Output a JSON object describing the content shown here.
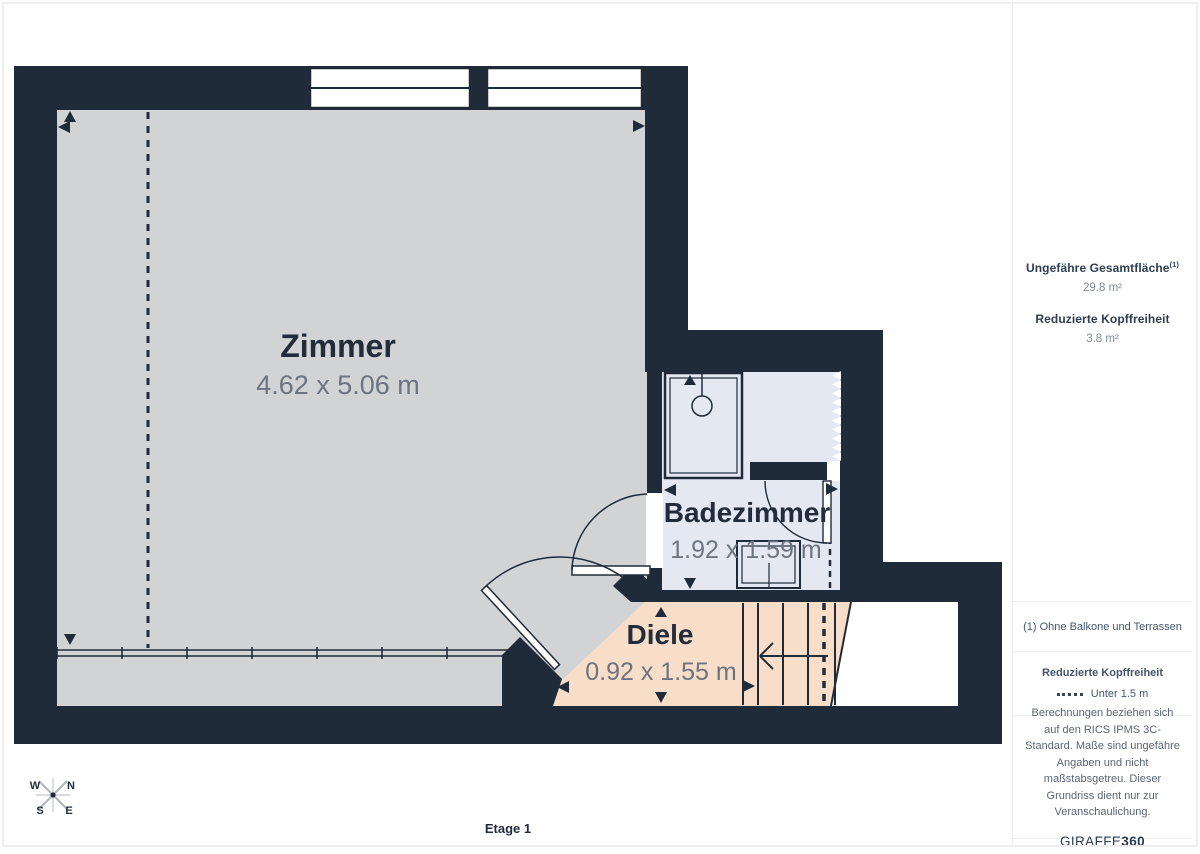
{
  "plan": {
    "floor_label": "Etage 1",
    "rooms": [
      {
        "name": "Zimmer",
        "dimensions": "4.62 x 5.06 m"
      },
      {
        "name": "Badezimmer",
        "dimensions": "1.92 x 1.59 m"
      },
      {
        "name": "Diele",
        "dimensions": "0.92 x 1.55 m"
      }
    ],
    "compass": {
      "north": "N",
      "south": "S",
      "east": "E",
      "west": "W"
    }
  },
  "sidebar": {
    "total_area_label": "Ungefähre Gesamtfläche",
    "total_area_footnote_marker": "(1)",
    "total_area_value": "29.8 m²",
    "reduced_headroom_label": "Reduzierte Kopffreiheit",
    "reduced_headroom_value": "3.8 m²",
    "footnote": "(1) Ohne Balkone und Terrassen",
    "legend_label": "Reduzierte Kopffreiheit",
    "legend_value": "Unter 1.5 m",
    "disclaimer": "Berechnungen beziehen sich auf den RICS IPMS 3C-Standard. Maße sind ungefähre Angaben und nicht maßstabsgetreu. Dieser Grundriss dient nur zur Veranschaulichung.",
    "brand_name": "GIRAFFE",
    "brand_suffix": "360"
  },
  "colors": {
    "wall": "#202b39",
    "room_floor": "#d2d3d5",
    "bathroom_floor": "#e4e8f3",
    "hallway_floor": "#f8ddc8",
    "label_text": "#222c3a",
    "dimension_text": "#6b7480",
    "border": "#e9ebee"
  }
}
